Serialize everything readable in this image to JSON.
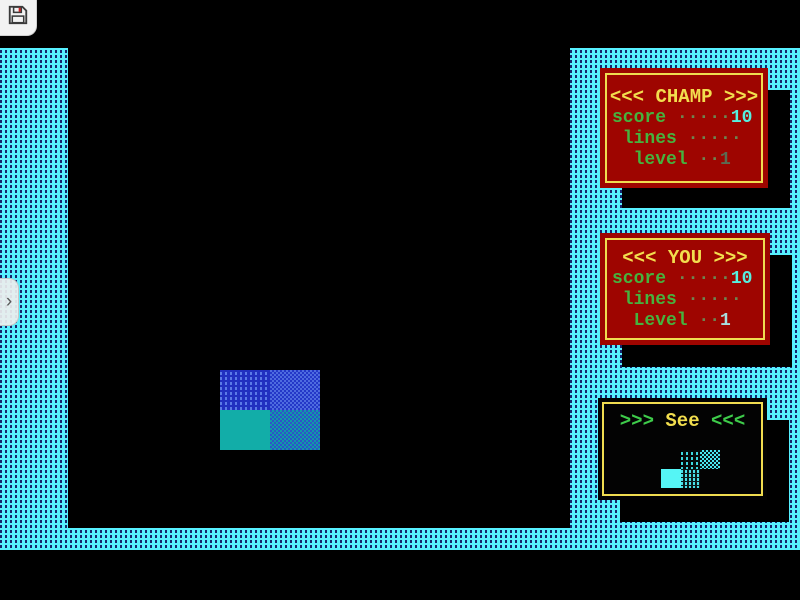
{
  "colors": {
    "border_cyan": "#57f0ff",
    "border_dash_navy": "#17256e",
    "panel_red": "#9e0500",
    "panel_border_yellow": "#f0dc50",
    "title_yellow": "#f2de4e",
    "label_green": "#46b33e",
    "value_cyan": "#55f0e0",
    "block_blue": "#2130c0",
    "block_teal": "#12ada8",
    "preview_cyan": "#55f5f5"
  },
  "overlay": {
    "save_icon": "floppy-save-icon",
    "drawer_chevron": "›"
  },
  "panels": {
    "champ": {
      "title": "<<< CHAMP >>>",
      "rows": [
        {
          "label": "score",
          "dots": " ·····",
          "value": "10"
        },
        {
          "label": " lines",
          "dots": " ·····",
          "value": ""
        },
        {
          "label": "  level",
          "dots": " ··",
          "value": "1"
        }
      ]
    },
    "you": {
      "title": "<<< YOU >>>",
      "rows": [
        {
          "label": "score",
          "dots": " ·····",
          "value": "10"
        },
        {
          "label": " lines",
          "dots": " ·····",
          "value": ""
        },
        {
          "label": "  Level",
          "dots": " ··",
          "value": "1"
        }
      ]
    },
    "see": {
      "title_left": ">>> ",
      "title_word": "See",
      "title_right": " <<<"
    }
  },
  "playfield": {
    "cells": [
      {
        "x": 220,
        "y": 370,
        "w": 50,
        "h": 40,
        "fill": "blue-dots"
      },
      {
        "x": 270,
        "y": 370,
        "w": 50,
        "h": 40,
        "fill": "blue-checker"
      },
      {
        "x": 220,
        "y": 410,
        "w": 50,
        "h": 40,
        "fill": "teal-solid"
      },
      {
        "x": 270,
        "y": 410,
        "w": 50,
        "h": 40,
        "fill": "teal-checker"
      }
    ]
  },
  "preview": {
    "cells": [
      {
        "x": 681,
        "y": 450,
        "w": 19,
        "h": 19,
        "fill": "cyan-dots"
      },
      {
        "x": 700,
        "y": 450,
        "w": 20,
        "h": 19,
        "fill": "cyan-checker"
      },
      {
        "x": 661,
        "y": 469,
        "w": 20,
        "h": 19,
        "fill": "cyan-solid"
      },
      {
        "x": 681,
        "y": 469,
        "w": 19,
        "h": 19,
        "fill": "cyan-dots-dense"
      }
    ]
  }
}
